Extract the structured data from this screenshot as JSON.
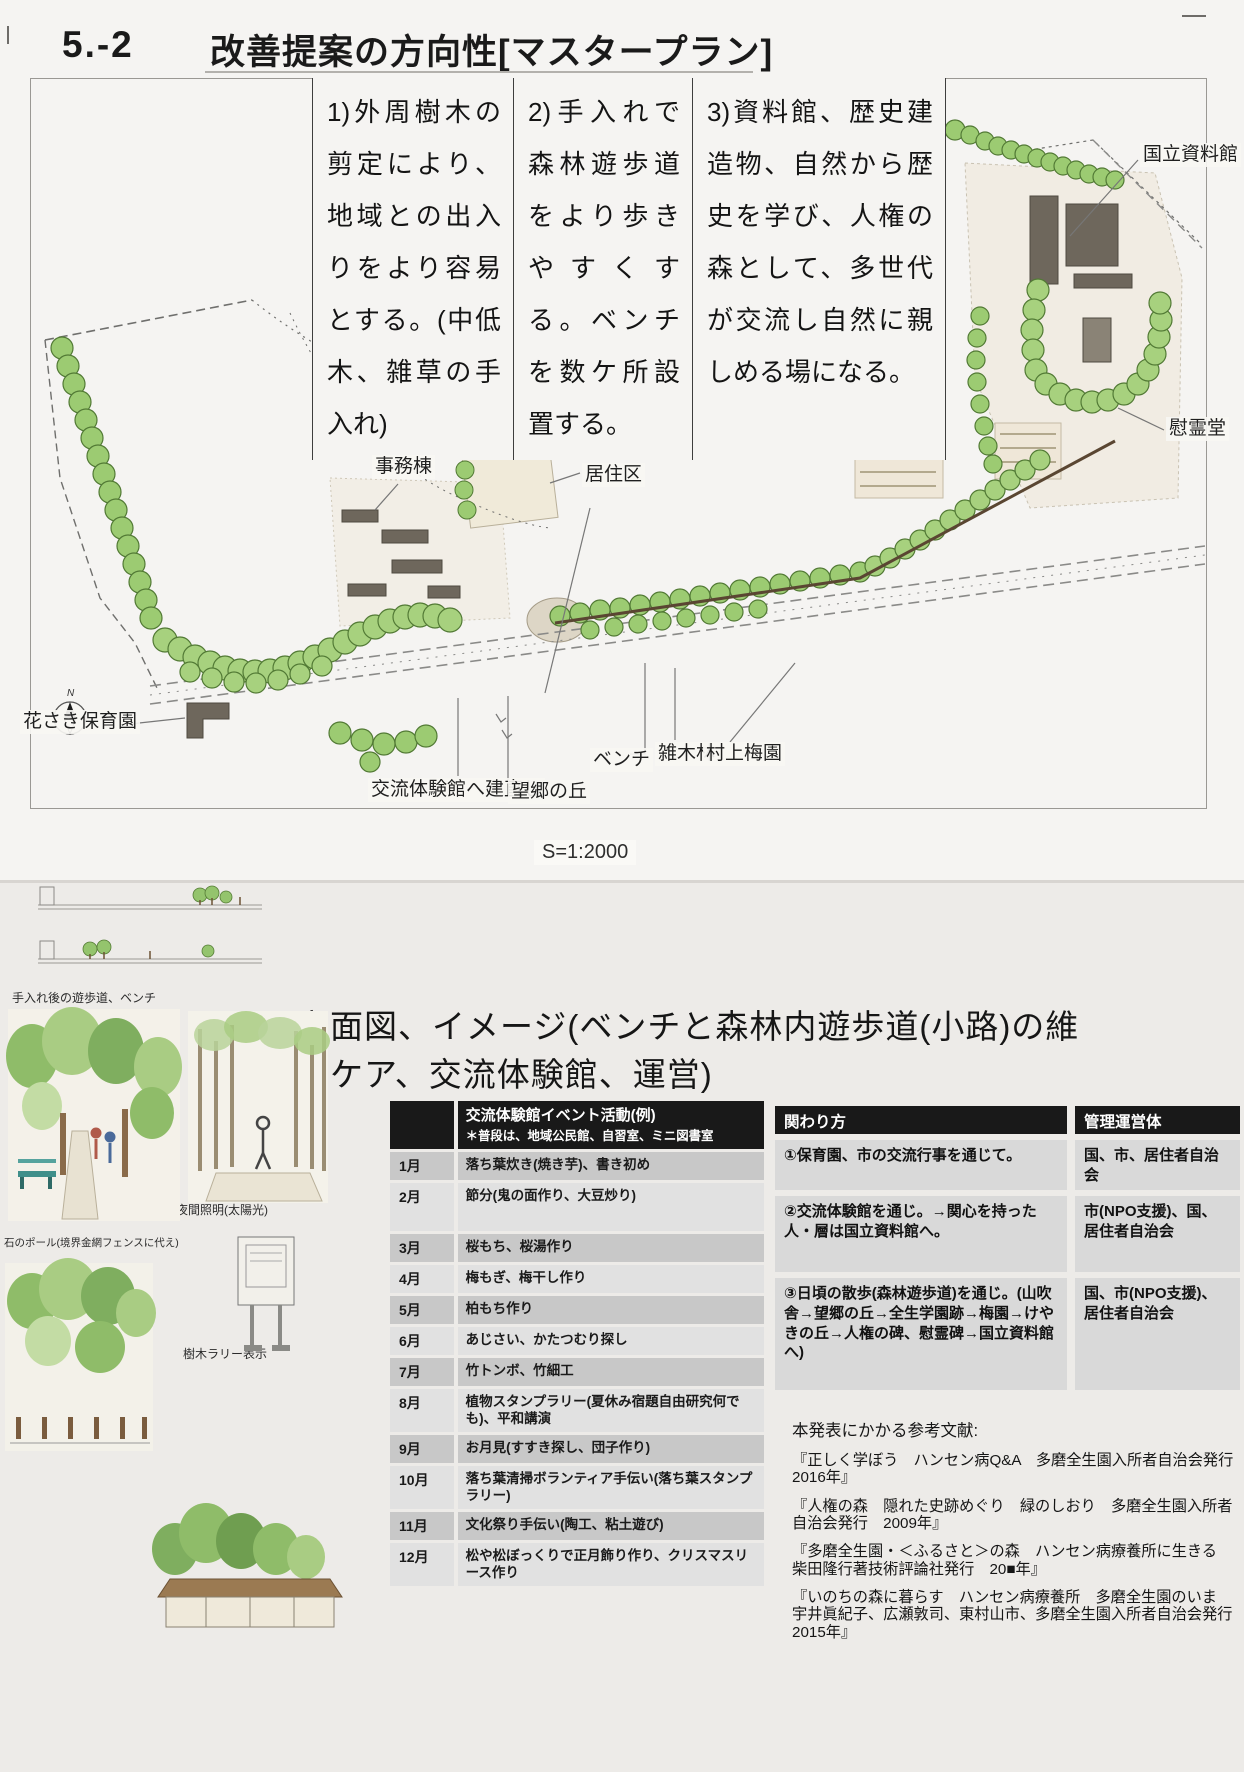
{
  "header": {
    "number": "5.-2",
    "title": "改善提案の方向性[マスタープラン]"
  },
  "proposals": {
    "p1": "1)外周樹木の剪定により、地域との出入りをより容易とする。(中低木、雑草の手入れ)",
    "p2": "2)手入れで森林遊歩道をより歩きやすくする。ベンチを数ケ所設置する。",
    "p3": "3)資料館、歴史建造物、自然から歴史を学び、人権の森として、多世代が交流し自然に親しめる場になる。"
  },
  "map": {
    "labels": {
      "museum": "国立資料館",
      "memorial": "慰霊堂",
      "office": "事務棟",
      "residence": "居住区",
      "nursery": "花さき保育園",
      "hall": "交流体験館へ建直し",
      "hill": "望郷の丘",
      "bench": "ベンチ",
      "woods": "雑木林",
      "plum": "村上梅園"
    },
    "scale": "S=1:2000",
    "north": "N"
  },
  "lower": {
    "title": "立面図、イメージ(ベンチと森林内遊歩道(小路)の維持ケア、交流体験館、運営)",
    "sketches": {
      "path": "手入れ後の遊歩道、ベンチ",
      "light": "夜間照明(太陽光)",
      "pole": "石のポール(境界金網フェンスに代え)",
      "rally": "樹木ラリー表示",
      "hall": "交流・体験館"
    },
    "events": {
      "title": "交流体験館イベント活動(例)",
      "note": "＊普段は、地域公民館、自習室、ミニ図書室",
      "rows": [
        {
          "m": "1月",
          "a": "落ち葉炊き(焼き芋)、書き初め"
        },
        {
          "m": "2月",
          "a": "節分(鬼の面作り、大豆炒り)"
        },
        {
          "m": "3月",
          "a": "桜もち、桜湯作り"
        },
        {
          "m": "4月",
          "a": "梅もぎ、梅干し作り"
        },
        {
          "m": "5月",
          "a": "柏もち作り"
        },
        {
          "m": "6月",
          "a": "あじさい、かたつむり探し"
        },
        {
          "m": "7月",
          "a": "竹トンボ、竹細工"
        },
        {
          "m": "8月",
          "a": "植物スタンプラリー(夏休み宿題自由研究何でも)、平和講演"
        },
        {
          "m": "9月",
          "a": "お月見(すすき探し、団子作り)"
        },
        {
          "m": "10月",
          "a": "落ち葉清掃ボランティア手伝い(落ち葉スタンプラリー)"
        },
        {
          "m": "11月",
          "a": "文化祭り手伝い(陶工、粘土遊び)"
        },
        {
          "m": "12月",
          "a": "松や松ぼっくりで正月飾り作り、クリスマスリース作り"
        }
      ]
    },
    "involvement": {
      "header": "関わり方",
      "mgmt_header": "管理運営体",
      "rows": [
        {
          "how": "①保育園、市の交流行事を通じて。",
          "mgmt": "国、市、居住者自治会"
        },
        {
          "how": "②交流体験館を通じ。→関心を持った人・層は国立資料館へ。",
          "mgmt": "市(NPO支援)、国、居住者自治会"
        },
        {
          "how": "③日頃の散歩(森林遊歩道)を通じ。(山吹舎→望郷の丘→全生学園跡→梅園→けやきの丘→人権の碑、慰霊碑→国立資料館へ)",
          "mgmt": "国、市(NPO支援)、居住者自治会"
        }
      ]
    },
    "references": {
      "heading": "本発表にかかる参考文献:",
      "items": [
        "『正しく学ぼう　ハンセン病Q&A　多磨全生園入所者自治会発行　2016年』",
        "『人権の森　隠れた史跡めぐり　緑のしおり　多磨全生園入所者自治会発行　2009年』",
        "『多磨全生園・＜ふるさと＞の森　ハンセン病療養所に生きる　柴田隆行著技術評論社発行　20■年』",
        "『いのちの森に暮らす　ハンセン病療養所　多磨全生園のいま　宇井眞紀子、広瀬敦司、東村山市、多磨全生園入所者自治会発行　2015年』"
      ]
    }
  },
  "colors": {
    "tree_green": "#9ccb72",
    "table_header_black": "#191919",
    "row_gray_dark": "#c8c8c8",
    "row_gray_light": "#e1e1e1"
  }
}
